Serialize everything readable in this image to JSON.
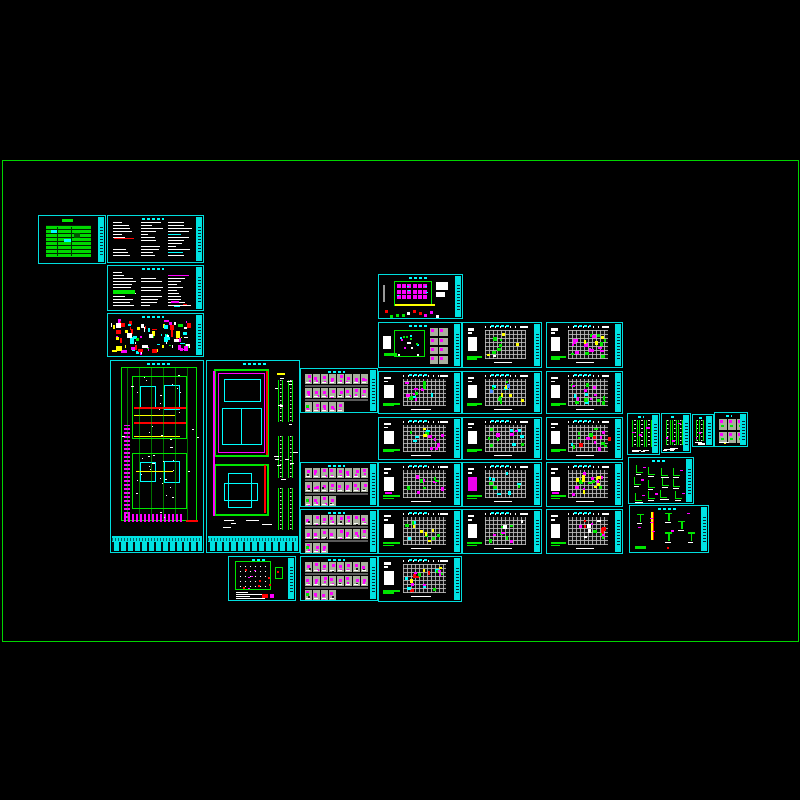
{
  "app": {
    "description": "CAD model-space mosaic of structural drawing sheets"
  },
  "palette": {
    "background": "#000000",
    "frame_green": "#00d400",
    "sheet_border_cyan": "#00dede",
    "title_strip_cyan": "#00e2e2",
    "bright_green": "#00e600",
    "magenta": "#ff00ff",
    "red": "#ff0000",
    "yellow": "#ffff00",
    "white": "#ffffff",
    "cyan": "#00ffff",
    "plan_gray": "#bebebe",
    "cell_gray": "#a9af9e",
    "cover_table_green": "#00d800"
  },
  "frame": {
    "x": 2,
    "y": 160,
    "w": 795,
    "h": 480
  },
  "sheets": [
    {
      "id": "cover-sheet",
      "type": "cover",
      "x": 38,
      "y": 215,
      "w": 68,
      "h": 49,
      "title": "right"
    },
    {
      "id": "notes-sheet-1",
      "type": "notes",
      "x": 107,
      "y": 215,
      "w": 97,
      "h": 48,
      "title": "right",
      "extras": [
        {
          "c": "#ff0000",
          "x": 0.06,
          "y": 0.45,
          "w": 0.22,
          "h": 0.03
        }
      ]
    },
    {
      "id": "notes-sheet-2",
      "type": "notes",
      "x": 107,
      "y": 265,
      "w": 97,
      "h": 46,
      "title": "right",
      "extras": [
        {
          "c": "#00e600",
          "x": 0.05,
          "y": 0.52,
          "w": 0.24,
          "h": 0.1
        },
        {
          "c": "#ff00ff",
          "x": 0.7,
          "y": 0.78,
          "w": 0.1,
          "h": 0.035
        },
        {
          "c": "#ff0000",
          "x": 0.84,
          "y": 0.84,
          "w": 0.05,
          "h": 0.035
        },
        {
          "c": "#00ffff",
          "x": 0.74,
          "y": 0.88,
          "w": 0.07,
          "h": 0.03
        }
      ]
    },
    {
      "id": "general-details-sheet",
      "type": "scatter",
      "x": 107,
      "y": 313,
      "w": 97,
      "h": 44,
      "title": "right",
      "density": 85,
      "accents": [
        "#ffffff",
        "#ffffff",
        "#ff00ff",
        "#ff00ff",
        "#ff0000",
        "#00ffff",
        "#00e600",
        "#ffff00"
      ],
      "extras": [
        {
          "c": "#ffff00",
          "x": 0.76,
          "y": 0.38,
          "w": 0.045,
          "h": 0.16
        },
        {
          "c": "#ff0000",
          "x": 0.7,
          "y": 0.34,
          "w": 0.03,
          "h": 0.18
        }
      ]
    },
    {
      "id": "floor-plan-a",
      "type": "plan-a",
      "x": 110,
      "y": 360,
      "w": 94,
      "h": 193,
      "title": "bottom"
    },
    {
      "id": "floor-plan-b",
      "type": "plan-b",
      "x": 206,
      "y": 360,
      "w": 94,
      "h": 193,
      "title": "bottom"
    },
    {
      "id": "foundation-grid-plan",
      "type": "grid-plan",
      "x": 228,
      "y": 556,
      "w": 68,
      "h": 45,
      "title": "right"
    },
    {
      "id": "beam-details-a",
      "type": "cells",
      "x": 300,
      "y": 368,
      "w": 78,
      "h": 45,
      "title": "right",
      "rows": [
        8,
        8,
        5
      ]
    },
    {
      "id": "beam-details-b",
      "type": "cells",
      "x": 300,
      "y": 462,
      "w": 78,
      "h": 45,
      "title": "right",
      "rows": [
        8,
        8,
        4
      ]
    },
    {
      "id": "beam-details-c",
      "type": "cells",
      "x": 300,
      "y": 509,
      "w": 78,
      "h": 45,
      "title": "right",
      "rows": [
        8,
        8,
        3
      ]
    },
    {
      "id": "beam-details-d",
      "type": "cells",
      "x": 300,
      "y": 556,
      "w": 78,
      "h": 45,
      "title": "right",
      "rows": [
        8,
        8,
        4
      ]
    },
    {
      "id": "pile-layout-plan",
      "type": "pile",
      "x": 378,
      "y": 274,
      "w": 85,
      "h": 45,
      "title": "right"
    },
    {
      "id": "plan-with-detail-cells",
      "type": "plan-cells",
      "x": 378,
      "y": 322,
      "w": 84,
      "h": 46,
      "title": "right"
    },
    {
      "id": "framing-plan-m3",
      "type": "framing",
      "x": 378,
      "y": 371,
      "w": 84,
      "h": 43,
      "title": "right",
      "density": 12,
      "accents": [
        "#00e600",
        "#ff00ff",
        "#00ffff"
      ]
    },
    {
      "id": "framing-plan-m4",
      "type": "framing",
      "x": 378,
      "y": 417,
      "w": 84,
      "h": 43,
      "title": "right",
      "density": 14,
      "accents": [
        "#00e600",
        "#ffff00",
        "#ff00ff",
        "#00ffff"
      ]
    },
    {
      "id": "framing-plan-m5",
      "type": "framing",
      "x": 378,
      "y": 462,
      "w": 84,
      "h": 45,
      "title": "right",
      "density": 10,
      "accents": [
        "#00e600",
        "#ff00ff"
      ],
      "block_dash": "#ff00ff"
    },
    {
      "id": "framing-plan-m6",
      "type": "framing",
      "x": 378,
      "y": 509,
      "w": 84,
      "h": 45,
      "title": "right",
      "density": 12,
      "accents": [
        "#00e600",
        "#00ffff",
        "#ffff00"
      ]
    },
    {
      "id": "framing-plan-m7",
      "type": "framing",
      "x": 378,
      "y": 556,
      "w": 84,
      "h": 46,
      "title": "right",
      "density": 20,
      "accents": [
        "#ffff00",
        "#00e600",
        "#00ffff",
        "#ff00ff",
        "#ff0000"
      ]
    },
    {
      "id": "framing-plan-r1",
      "type": "framing",
      "x": 462,
      "y": 322,
      "w": 80,
      "h": 46,
      "title": "right",
      "density": 9,
      "accents": [
        "#00e600",
        "#ffffff",
        "#ffff00"
      ]
    },
    {
      "id": "framing-plan-r2",
      "type": "framing",
      "x": 462,
      "y": 371,
      "w": 80,
      "h": 43,
      "title": "right",
      "density": 14,
      "accents": [
        "#00ffff",
        "#00e600",
        "#ffff00",
        "#4488ff"
      ]
    },
    {
      "id": "framing-plan-r3",
      "type": "framing",
      "x": 462,
      "y": 417,
      "w": 80,
      "h": 43,
      "title": "right",
      "density": 12,
      "accents": [
        "#00e600",
        "#00ffff",
        "#ff00ff"
      ]
    },
    {
      "id": "framing-plan-r4",
      "type": "framing",
      "x": 462,
      "y": 462,
      "w": 80,
      "h": 45,
      "title": "right",
      "density": 10,
      "accents": [
        "#00e600",
        "#00ffff"
      ],
      "block_color": "#ee00ee"
    },
    {
      "id": "framing-plan-r5",
      "type": "framing",
      "x": 462,
      "y": 509,
      "w": 80,
      "h": 45,
      "title": "right",
      "density": 10,
      "accents": [
        "#00e600",
        "#ffffff",
        "#ff00ff"
      ]
    },
    {
      "id": "framing-plan-s1",
      "type": "framing",
      "x": 546,
      "y": 322,
      "w": 77,
      "h": 46,
      "title": "right",
      "density": 22,
      "accents": [
        "#ff00ff",
        "#ff00ff",
        "#ff00ff",
        "#00e600",
        "#ffff00"
      ]
    },
    {
      "id": "framing-plan-s2",
      "type": "framing",
      "x": 546,
      "y": 371,
      "w": 77,
      "h": 43,
      "title": "right",
      "density": 16,
      "accents": [
        "#ff00ff",
        "#00ffff",
        "#00e600"
      ]
    },
    {
      "id": "framing-plan-s3",
      "type": "framing",
      "x": 546,
      "y": 417,
      "w": 77,
      "h": 43,
      "title": "right",
      "density": 16,
      "accents": [
        "#ff00ff",
        "#ff0000",
        "#00ffff",
        "#00e600"
      ],
      "extras": [
        {
          "c": "#ff0000",
          "x": 0.88,
          "y": 0.45,
          "w": 0.05,
          "h": 0.09
        }
      ]
    },
    {
      "id": "framing-plan-s4",
      "type": "framing",
      "x": 546,
      "y": 462,
      "w": 77,
      "h": 45,
      "title": "right",
      "density": 20,
      "accents": [
        "#ff00ff",
        "#ff00ff",
        "#ffff00",
        "#00e600"
      ],
      "block_dash": "#ff00ff"
    },
    {
      "id": "framing-plan-s5",
      "type": "framing",
      "x": 546,
      "y": 509,
      "w": 77,
      "h": 45,
      "title": "right",
      "density": 16,
      "accents": [
        "#ff0000",
        "#ff00ff",
        "#00e600",
        "#ffffff"
      ]
    },
    {
      "id": "stair-details-1",
      "type": "stairs",
      "x": 627,
      "y": 413,
      "w": 33,
      "h": 42,
      "title": "right",
      "ladders": 3
    },
    {
      "id": "stair-details-2",
      "type": "stairs",
      "x": 661,
      "y": 413,
      "w": 30,
      "h": 40,
      "title": "right",
      "ladders": 3
    },
    {
      "id": "misc-small-details",
      "type": "stairs",
      "x": 692,
      "y": 414,
      "w": 22,
      "h": 33,
      "title": "right",
      "ladders": 2
    },
    {
      "id": "joint-details",
      "type": "cells-small",
      "x": 714,
      "y": 412,
      "w": 34,
      "h": 35,
      "title": "right"
    },
    {
      "id": "section-details",
      "type": "glyphs",
      "x": 628,
      "y": 457,
      "w": 66,
      "h": 47,
      "title": "right"
    },
    {
      "id": "column-details",
      "type": "col-details",
      "x": 629,
      "y": 505,
      "w": 80,
      "h": 48,
      "title": "right"
    }
  ]
}
